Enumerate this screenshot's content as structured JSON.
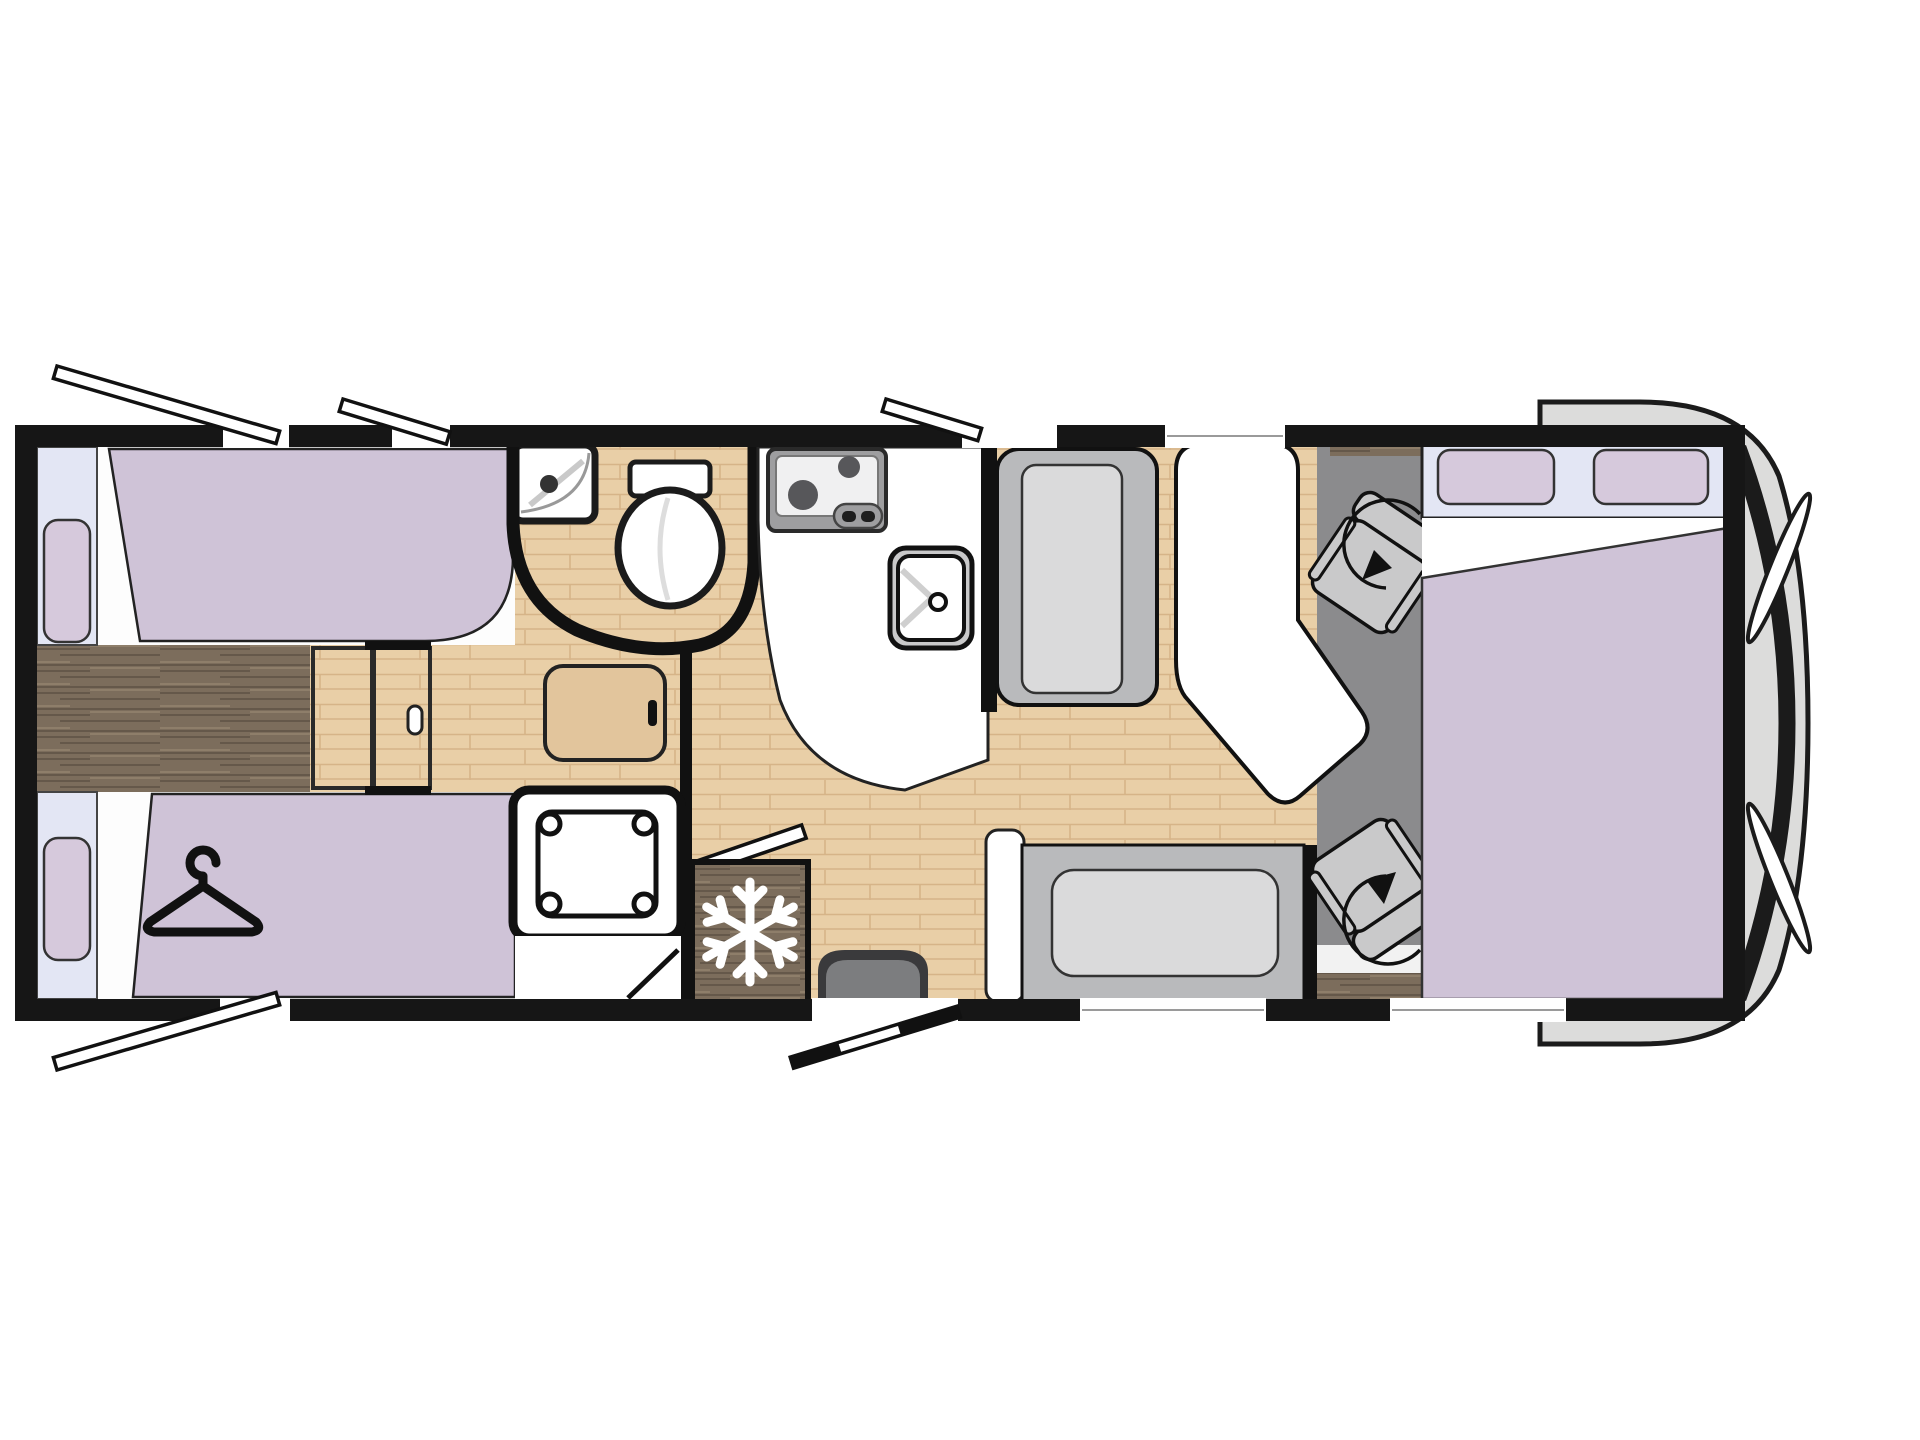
{
  "diagram": {
    "type": "motorhome-floorplan",
    "view": "top-down",
    "vehicle_front": "right",
    "rooms": [
      {
        "name": "rear-bedroom",
        "features": [
          "twin-single-bed-top",
          "twin-single-bed-bottom",
          "rear-window-top",
          "rear-window-bottom",
          "pillow-top",
          "pillow-bottom",
          "wardrobe-under-bed",
          "center-step-cabinets",
          "bedside-cabinet"
        ]
      },
      {
        "name": "washroom",
        "features": [
          "corner-washbasin",
          "toilet",
          "curved-partition-wall"
        ]
      },
      {
        "name": "shower",
        "features": [
          "shower-tray",
          "shower-door"
        ]
      },
      {
        "name": "kitchen",
        "features": [
          "two-burner-hob",
          "kitchen-sink",
          "refrigerator"
        ]
      },
      {
        "name": "dinette",
        "features": [
          "forward-facing-bench",
          "side-bench",
          "table",
          "entry-step"
        ]
      },
      {
        "name": "cab",
        "features": [
          "driver-swivel-seat",
          "passenger-swivel-seat",
          "drop-down-bed",
          "cab-pillow-left",
          "cab-pillow-right",
          "windscreen"
        ]
      }
    ],
    "openings": {
      "top_wall_open_windows": 3,
      "bottom_wall_open_windows": 1,
      "entry_door": "bottom wall, open",
      "fixed_windows": [
        "bottom-side-bench-window",
        "bottom-cab-window"
      ]
    }
  },
  "icons": [
    {
      "name": "snowflake-icon",
      "meaning": "refrigerator"
    },
    {
      "name": "hanger-icon",
      "meaning": "wardrobe"
    },
    {
      "name": "swivel-arrow-icon",
      "meaning": "rotating cab seat"
    }
  ],
  "colors": {
    "line-dark": "#1b1b1b",
    "wall": "#161616",
    "floor-light": "#e9cfa7",
    "floor-light-line": "#d6b488",
    "floor-dark": "#7c6d5c",
    "floor-dark-line": "#65584a",
    "floor-dark-hi": "#93846f",
    "mattress": "#cfc3d7",
    "pillow": "#d6c9dc",
    "window-band": "#e3e6f4",
    "seat": "#b9babc",
    "cushion": "#dadadb",
    "cab-floor": "#8b8b8d",
    "cab-seat": "#c9c9ca",
    "nose": "#dcdcdb",
    "fixture-white": "#ffffff",
    "hob": "#9e9ea0",
    "hob-plate": "#f0f0f1",
    "burner": "#57575a",
    "step-dark": "#3a3a3c",
    "step-mid": "#7c7d7f",
    "cabinet-wood": "#e2c59c"
  }
}
